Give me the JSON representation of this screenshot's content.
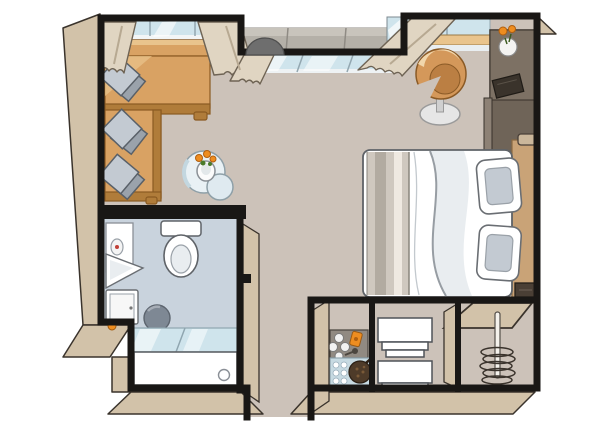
{
  "meta": {
    "description": "Illustrated top-down floor plan of a studio stateroom: lounge with L-shaped desk-sofa, coffee table, swivel chair, media cabinet, double bed, bathroom, kitchenette counter, shelf stacks, closet with hanger rail, and French-balcony windows with curtains"
  },
  "palette": {
    "floor": "#ccc2b9",
    "bathFloor": "#c9d3dd",
    "wall": "#191715",
    "wallFace": "#d2c2a9",
    "wood": "#d9a263",
    "woodDark": "#b07c3a",
    "woodLight": "#e9c48d",
    "cushion": "#c3cad2",
    "cushionDark": "#9aa2ab",
    "glass": "#cfe4ec",
    "curtain": "#e0d5c2",
    "railing": "#b4b0a8",
    "chair": "#d4985a",
    "chairInner": "#bb7f43",
    "white": "#ffffff",
    "runner": "#cfc8bf",
    "headboard": "#c9a377",
    "cabinet": "#6f6458",
    "cabinetLight": "#7d7164",
    "accent": "#ee8d20",
    "leaf": "#4a7a2a",
    "counter": "#918a82",
    "tray": "#4e3b29",
    "stool": "#7e8894",
    "lamp": "#cbb79b",
    "tv": "#3a332b",
    "safe": "#4a3f35"
  },
  "scene": {
    "rooms": [
      {
        "id": "living-area",
        "items": [
          "l-shaped-desk-sofa",
          "seat-cushions",
          "coffee-table",
          "flower-vase"
        ]
      },
      {
        "id": "sleeping-area",
        "items": [
          "double-bed",
          "pillows",
          "headboard",
          "reading-lights",
          "swivel-chair",
          "media-cabinet",
          "tv",
          "flower-vase"
        ]
      },
      {
        "id": "bathroom",
        "items": [
          "toilet",
          "mirror-cabinet",
          "corner-washbasin",
          "vanity-cabinet",
          "stool",
          "bathtub",
          "glass-screen",
          "drain"
        ]
      },
      {
        "id": "kitchenette",
        "items": [
          "counter",
          "sink-faucet",
          "knobs",
          "tray",
          "orange-accessory"
        ]
      },
      {
        "id": "entry-corridor",
        "items": [
          "shelf-stacks"
        ]
      },
      {
        "id": "closet",
        "items": [
          "clothes-rail",
          "hangers",
          "shelf",
          "safe-box"
        ]
      },
      {
        "id": "veranda",
        "items": [
          "balcony-railing",
          "balcony-table",
          "windows",
          "curtains"
        ]
      }
    ]
  }
}
